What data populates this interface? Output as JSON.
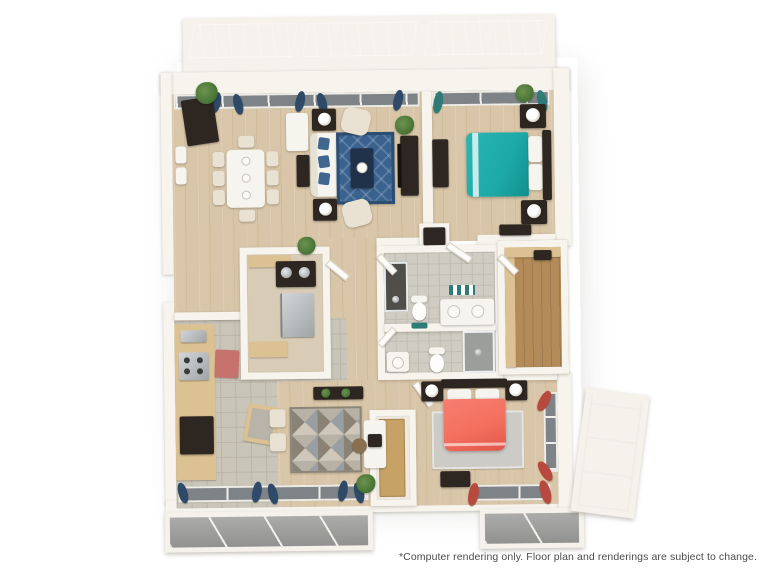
{
  "disclaimer": "*Computer rendering only. Floor plan and renderings are subject to change.",
  "colors": {
    "bg": "#ffffff",
    "text": "#4b4b4d",
    "wall": "#f7f4ee",
    "wood": "#d9c6a8",
    "tile": "#c9c5b9",
    "tile-grout": "#b9b5a8",
    "bath-tile": "#cfccc3",
    "bath-grout": "#c0bdb3",
    "closet-wood": "#b28b59",
    "balcony-floor": "#a2a2a0",
    "balcony-line": "#f3f1ec",
    "glass": "#a6abae",
    "glass-light": "#c3c7ca",
    "window-glass": "#7d8386",
    "dark-furniture": "#2e2721",
    "tan-cabinet": "#dcc192",
    "tan-door": "#c7a266",
    "white-furniture": "#f6f4ee",
    "cream": "#e9e2d2",
    "teal-bed": "#1ca9a7",
    "coral-bed": "#f3705f",
    "blue-rug": "#3a628f",
    "coffee-table": "#20314a",
    "gray-rug": "#cccbc6",
    "geo-a": "#989ea2",
    "geo-b": "#cfc8ba",
    "geo-c": "#8a8275",
    "geo-d": "#b8b1a5",
    "navy-curtain": "#2e4a68",
    "pillow-blue": "#3f668f",
    "teal-curtain": "#2e7b78",
    "red-curtain": "#b8493f",
    "red-mat": "#c5736c",
    "plant": "#4d7a39",
    "plant-dark": "#375f2a"
  },
  "floor_plan": {
    "view": "3d-top-down-computer-rendering",
    "rooms": [
      {
        "name": "balcony-north",
        "features": [
          "glass-panel-railing"
        ]
      },
      {
        "name": "living-dining-room",
        "furniture": [
          "dark-sideboard",
          "wall-art-frames",
          "dining-table",
          "dining-chairs",
          "white-cabinet",
          "console-table",
          "sofa",
          "navy-accent-pillows",
          "end-tables-with-lamps",
          "accent-armchairs",
          "blue-diamond-rug",
          "coffee-table",
          "media-console-with-tv",
          "potted-plants",
          "navy-curtains"
        ]
      },
      {
        "name": "bedroom-1",
        "furniture": [
          "teal-bed",
          "nightstands-with-lamps",
          "dresser",
          "accent-chest",
          "wardrobe-closet",
          "potted-plant",
          "teal-curtains"
        ]
      },
      {
        "name": "bathroom-1",
        "fixtures": [
          "walk-in-shower",
          "toilet",
          "double-sink-vanity",
          "teal-wall-accent",
          "teal-bath-mat"
        ]
      },
      {
        "name": "bathroom-2",
        "fixtures": [
          "shower",
          "toilet",
          "single-sink-vanity"
        ]
      },
      {
        "name": "walk-in-closet",
        "features": [
          "built-in-shelving"
        ]
      },
      {
        "name": "laundry-utility-room",
        "features": [
          "counter",
          "stacked-washer-dryer",
          "refrigerator",
          "storage-shelf"
        ]
      },
      {
        "name": "kitchen",
        "features": [
          "tan-cabinets",
          "range",
          "wall-oven",
          "sink",
          "kitchen-island",
          "red-mat",
          "tile-floor"
        ]
      },
      {
        "name": "den-office",
        "furniture": [
          "geometric-mosaic-rug",
          "desk",
          "desk-chair",
          "monitor",
          "console-table",
          "side-chairs",
          "potted-plant"
        ]
      },
      {
        "name": "entry-nook",
        "features": [
          "wood-door"
        ]
      },
      {
        "name": "bedroom-2",
        "furniture": [
          "coral-bed",
          "nightstands-with-lamps",
          "gray-rug",
          "storage-bench",
          "red-curtains"
        ]
      },
      {
        "name": "balcony-south-left",
        "features": [
          "glass-panel-railing"
        ]
      },
      {
        "name": "balcony-south-right",
        "features": [
          "glass-panel-railing"
        ]
      },
      {
        "name": "balcony-east-bay",
        "features": [
          "glass-panel-railing"
        ]
      }
    ]
  }
}
